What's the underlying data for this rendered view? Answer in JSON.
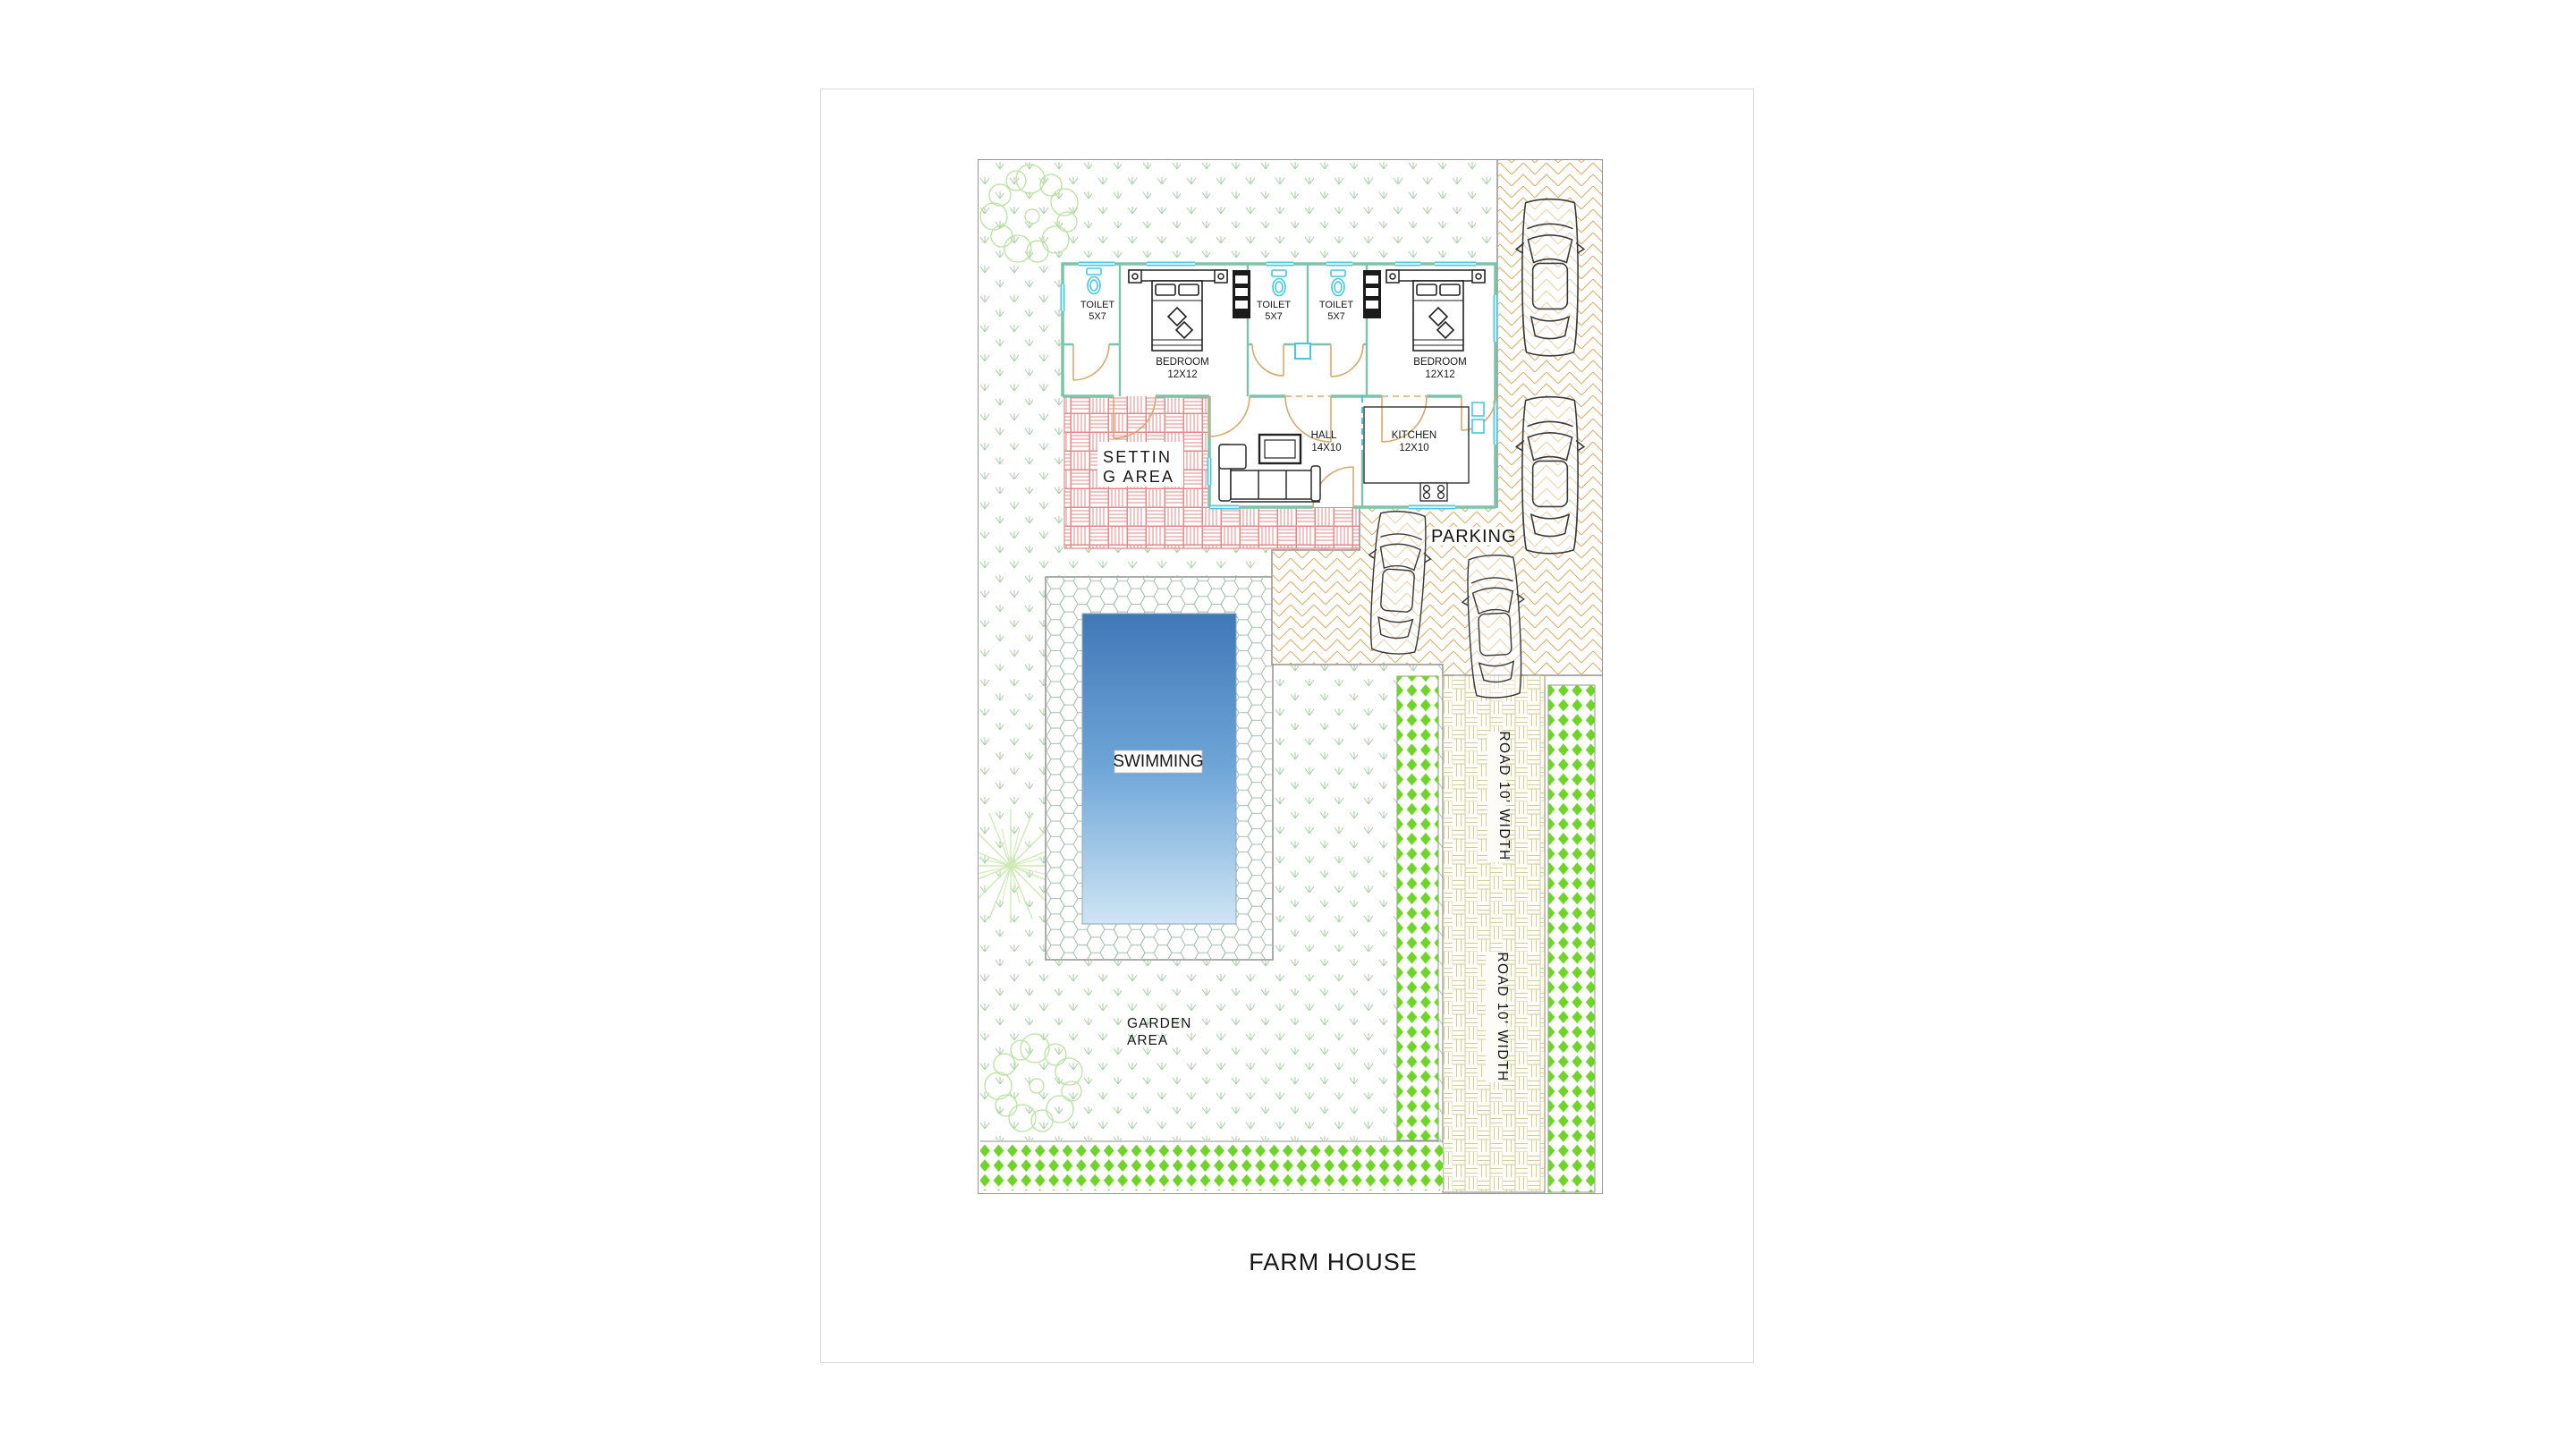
{
  "sheet": {
    "title": "FARM HOUSE"
  },
  "plan": {
    "rooms": {
      "toilet1": {
        "name": "TOILET",
        "size": "5X7"
      },
      "toilet2": {
        "name": "TOILET",
        "size": "5X7"
      },
      "toilet3": {
        "name": "TOILET",
        "size": "5X7"
      },
      "bedroom1": {
        "name": "BEDROOM",
        "size": "12X12"
      },
      "bedroom2": {
        "name": "BEDROOM",
        "size": "12X12"
      },
      "hall": {
        "name": "HALL",
        "size": "14X10"
      },
      "kitchen": {
        "name": "KITCHEN",
        "size": "12X10"
      }
    },
    "areas": {
      "setting_line1": "SETTIN",
      "setting_line2": "G AREA",
      "parking": "PARKING",
      "swimming": "SWIMMING",
      "garden_line1": "GARDEN",
      "garden_line2": "AREA",
      "road_upper": "ROAD 10' WIDTH",
      "road_lower": "ROAD 10' WIDTH"
    },
    "colors": {
      "wall_teal": "#7cc4a9",
      "window_cyan": "#4fc9e3",
      "door_tan": "#d8a96c",
      "setting_pattern_red": "#e28989",
      "parking_herringbone": "#dcae66",
      "road_basket": "#d5cc9c",
      "hedge_green": "#6ed428",
      "grass_mark": "#a6cda6",
      "tree_outline": "#b9e39e",
      "pool_top": "#4078b8",
      "pool_bottom": "#cfe5f5",
      "boundary_gray": "#8a8a8a"
    }
  }
}
